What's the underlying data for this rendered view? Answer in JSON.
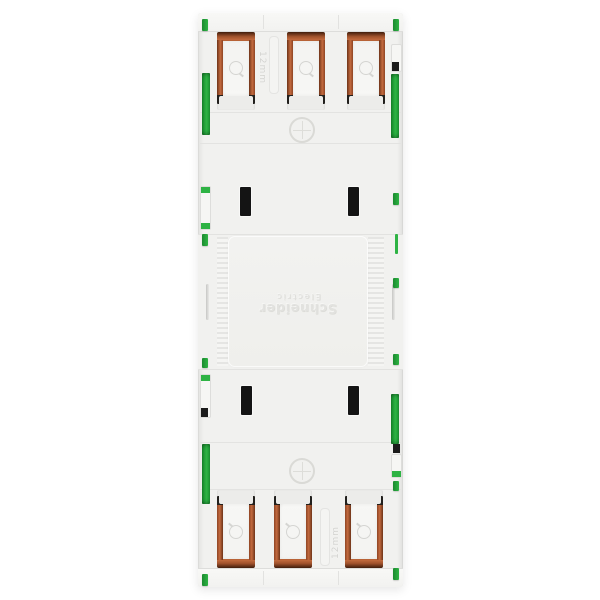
{
  "image": {
    "description": "Rear view of a white Schneider Electric modular wiring device with push-in terminals",
    "background_color": "#ffffff"
  },
  "branding": {
    "line1": "Schneider",
    "line2": "Electric",
    "orientation": "rotated-180-embossed"
  },
  "labels": {
    "strip_length_top": "12mm",
    "strip_length_bottom": "12mm"
  },
  "counts": {
    "terminals_top": 3,
    "terminals_bottom": 3,
    "module_slots": 4,
    "screw_markings": 2
  },
  "colors": {
    "body": "#f1f1ef",
    "insert": "#f3f3f1",
    "copper": "#a0522c",
    "copper_light": "#c26a3e",
    "tip_black": "#22201d",
    "clip_green": "#2eb344",
    "clip_green_dark": "#1a8a2e",
    "slot_black": "#141414"
  }
}
